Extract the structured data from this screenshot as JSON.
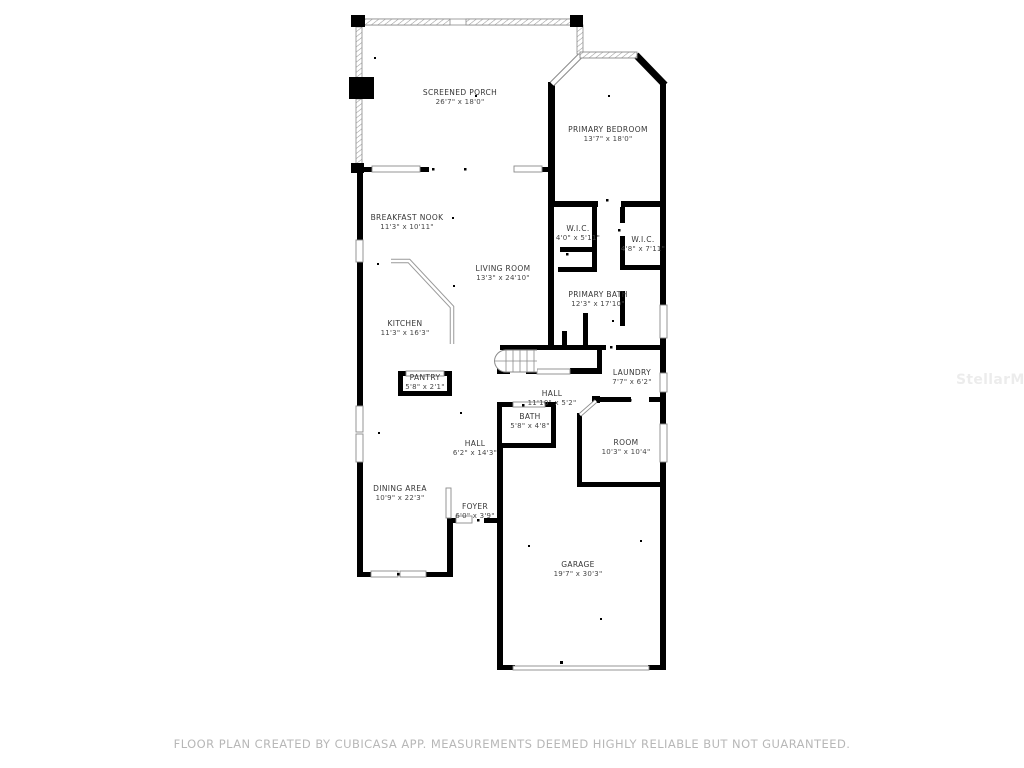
{
  "page": {
    "background": "#ffffff"
  },
  "watermark": {
    "text": "StellarMLS"
  },
  "footer": {
    "text": "FLOOR PLAN CREATED BY CUBICASA APP. MEASUREMENTS DEEMED HIGHLY RELIABLE BUT NOT GUARANTEED."
  },
  "colors": {
    "wall": "#000000",
    "window_fill": "#ffffff",
    "window_stroke": "#8a8a8a",
    "label_text": "#363636",
    "footer_text": "#b7b7b7"
  },
  "floor_plan": {
    "rooms": [
      {
        "id": "screened-porch",
        "name": "SCREENED PORCH",
        "dims": "26'7\" x 18'0\""
      },
      {
        "id": "primary-bedroom",
        "name": "PRIMARY BEDROOM",
        "dims": "13'7\" x 18'0\""
      },
      {
        "id": "breakfast-nook",
        "name": "BREAKFAST NOOK",
        "dims": "11'3\" x 10'11\""
      },
      {
        "id": "wic-1",
        "name": "W.I.C.",
        "dims": "4'0\" x 5'11\""
      },
      {
        "id": "wic-2",
        "name": "W.I.C.",
        "dims": "4'8\" x 7'11\""
      },
      {
        "id": "living-room",
        "name": "LIVING ROOM",
        "dims": "13'3\" x 24'10\""
      },
      {
        "id": "primary-bath",
        "name": "PRIMARY BATH",
        "dims": "12'3\" x 17'10\""
      },
      {
        "id": "kitchen",
        "name": "KITCHEN",
        "dims": "11'3\" x 16'3\""
      },
      {
        "id": "pantry",
        "name": "PANTRY",
        "dims": "5'8\" x 2'1\""
      },
      {
        "id": "hall-upper",
        "name": "HALL",
        "dims": "11'10\" x 5'2\""
      },
      {
        "id": "laundry",
        "name": "LAUNDRY",
        "dims": "7'7\" x 6'2\""
      },
      {
        "id": "bath",
        "name": "BATH",
        "dims": "5'8\" x 4'8\""
      },
      {
        "id": "room",
        "name": "ROOM",
        "dims": "10'3\" x 10'4\""
      },
      {
        "id": "hall-lower",
        "name": "HALL",
        "dims": "6'2\" x 14'3\""
      },
      {
        "id": "dining-area",
        "name": "DINING AREA",
        "dims": "10'9\" x 22'3\""
      },
      {
        "id": "foyer",
        "name": "FOYER",
        "dims": "6'0\" x 3'9\""
      },
      {
        "id": "garage",
        "name": "GARAGE",
        "dims": "19'7\" x 30'3\""
      }
    ]
  }
}
